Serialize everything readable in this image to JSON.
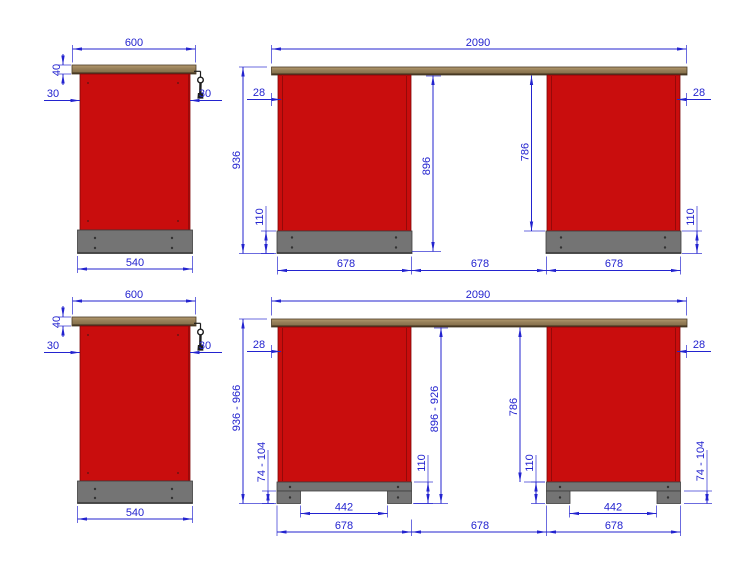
{
  "colors": {
    "red": "#c90d0d",
    "plinth_gray": "#747474",
    "worktop_brown": "#8b7355",
    "dimension_blue": "#2323cf",
    "key_black": "#1d1d1d",
    "background": "#ffffff"
  },
  "views": {
    "v1": {
      "w600": "600",
      "t40": "40",
      "o30l": "30",
      "o30r": "30",
      "b540": "540"
    },
    "v2": {
      "w2090": "2090",
      "o28l": "28",
      "o28r": "28",
      "h936": "936",
      "h896": "896",
      "h786": "786",
      "p110l": "110",
      "p110r": "110",
      "c678l": "678",
      "g678": "678",
      "c678r": "678"
    },
    "v3": {
      "w600": "600",
      "t40": "40",
      "o30l": "30",
      "o30r": "30",
      "b540": "540"
    },
    "v4": {
      "w2090": "2090",
      "o28l": "28",
      "o28r": "28",
      "h936": "936 - 966",
      "h896": "896 - 926",
      "h786": "786",
      "p110l": "110",
      "p110r": "110",
      "f74l": "74 - 104",
      "f74r": "74 - 104",
      "n442l": "442",
      "n442r": "442",
      "c678l": "678",
      "g678": "678",
      "c678r": "678"
    }
  }
}
